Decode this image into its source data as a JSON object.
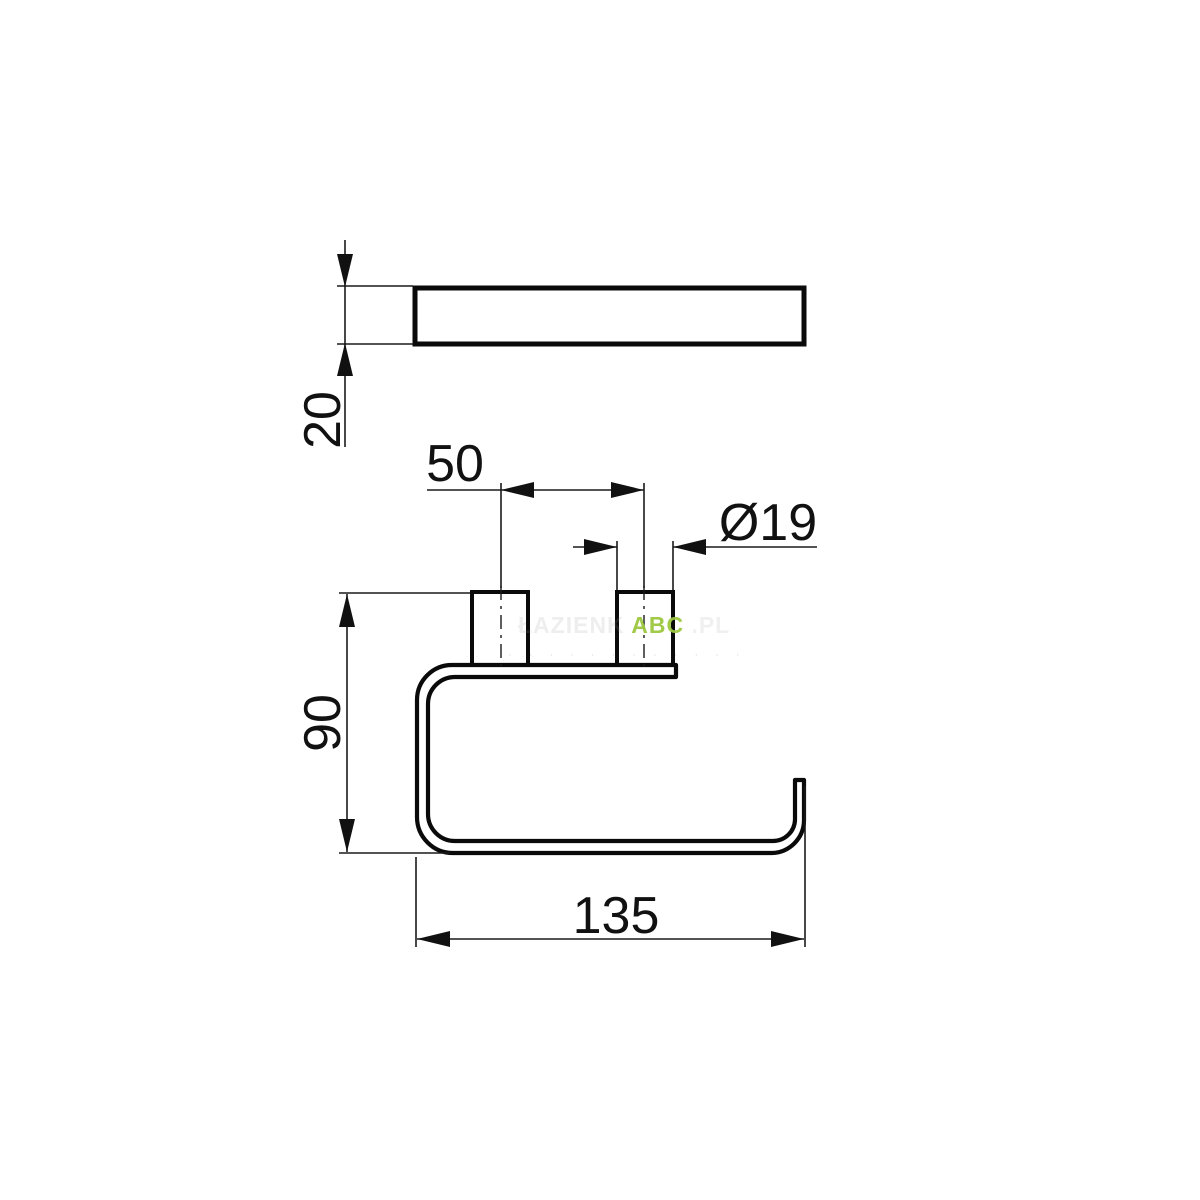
{
  "drawing": {
    "type": "technical-dimension-drawing",
    "views": {
      "top_view": "wall bar seen from above",
      "front_view": "paper holder profile with two mounting posts"
    },
    "dims": {
      "thickness": "20",
      "spacing": "50",
      "diameter": "Ø19",
      "height": "90",
      "width": "135"
    },
    "watermark": {
      "prefix": "ŁAZIENK",
      "brand": "ABC",
      "suffix": ".PL",
      "subline": "· · · · · · · · · · · ·"
    },
    "colors": {
      "background": "#ffffff",
      "outline": "#0a0a0a",
      "dimension_lines": "#1a1a1a",
      "watermark_green": "#9bc83e",
      "watermark_gray": "#999999"
    }
  }
}
